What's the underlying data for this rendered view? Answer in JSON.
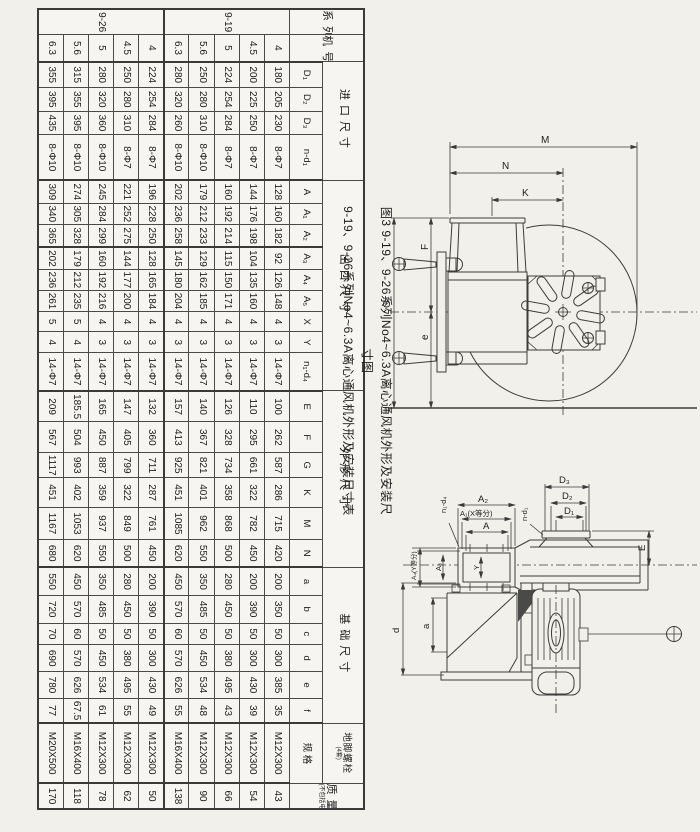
{
  "caption": {
    "line1": "图3  9-19、9-26系列No4~6.3A离心通风机外形及安装尺寸图",
    "line2": "9-19、9-26系列No4~6.3A离心通风机外形及安装尺寸表"
  },
  "table": {
    "header": {
      "series": "系列",
      "machine_no": "机号No",
      "groups": [
        {
          "label": "进口尺寸",
          "cols": [
            "D₁",
            "D₂",
            "D₃",
            "n-d₁"
          ]
        },
        {
          "label": "出口尺寸",
          "cols": [
            "A",
            "A₁",
            "A₂",
            "A₃",
            "A₄",
            "A₅",
            "X",
            "Y",
            "n₁-d₄"
          ]
        },
        {
          "label": "外形尺寸",
          "cols": [
            "E",
            "F",
            "G",
            "K",
            "M",
            "N"
          ]
        },
        {
          "label": "基础尺寸",
          "cols": [
            "a",
            "b",
            "c",
            "d",
            "e",
            "f"
          ]
        },
        {
          "label": "地脚螺栓",
          "sublabel": "(4套)",
          "cols": [
            "规 格"
          ]
        }
      ],
      "mass_label": "质量kg",
      "mass_sublabel": "(不包括电机)"
    },
    "rows": [
      {
        "series": "9-19",
        "no": "4",
        "v": [
          "180",
          "205",
          "230",
          "8-Φ7",
          "128",
          "160",
          "182",
          "92",
          "126",
          "148",
          "4",
          "3",
          "14-Φ7",
          "100",
          "262",
          "587",
          "286",
          "715",
          "420",
          "200",
          "350",
          "50",
          "300",
          "385",
          "35",
          "M12X300",
          "43"
        ]
      },
      {
        "series": "",
        "no": "4.5",
        "v": [
          "200",
          "225",
          "250",
          "8-Φ7",
          "144",
          "176",
          "198",
          "104",
          "135",
          "160",
          "4",
          "3",
          "14-Φ7",
          "110",
          "295",
          "661",
          "322",
          "782",
          "450",
          "200",
          "390",
          "50",
          "300",
          "430",
          "39",
          "M12X300",
          "54"
        ]
      },
      {
        "series": "",
        "no": "5",
        "v": [
          "224",
          "254",
          "284",
          "8-Φ7",
          "160",
          "192",
          "214",
          "115",
          "150",
          "171",
          "4",
          "3",
          "14-Φ7",
          "126",
          "328",
          "734",
          "358",
          "868",
          "500",
          "280",
          "450",
          "50",
          "380",
          "495",
          "43",
          "M12X300",
          "66"
        ]
      },
      {
        "series": "",
        "no": "5.6",
        "v": [
          "250",
          "280",
          "310",
          "8-Φ10",
          "179",
          "212",
          "233",
          "129",
          "162",
          "185",
          "4",
          "3",
          "14-Φ7",
          "140",
          "367",
          "821",
          "401",
          "962",
          "550",
          "350",
          "485",
          "50",
          "450",
          "534",
          "48",
          "M12X300",
          "90"
        ]
      },
      {
        "series": "",
        "no": "6.3",
        "v": [
          "280",
          "320",
          "260",
          "8-Φ10",
          "202",
          "236",
          "258",
          "145",
          "180",
          "204",
          "4",
          "3",
          "14-Φ7",
          "157",
          "413",
          "925",
          "451",
          "1085",
          "620",
          "450",
          "570",
          "60",
          "570",
          "626",
          "55",
          "M16X400",
          "138"
        ]
      },
      {
        "series": "9-26",
        "no": "4",
        "v": [
          "224",
          "254",
          "284",
          "8-Φ7",
          "196",
          "228",
          "250",
          "128",
          "165",
          "184",
          "4",
          "3",
          "14-Φ7",
          "132",
          "360",
          "711",
          "287",
          "761",
          "450",
          "200",
          "390",
          "50",
          "300",
          "430",
          "49",
          "M12X300",
          "50"
        ]
      },
      {
        "series": "",
        "no": "4.5",
        "v": [
          "250",
          "280",
          "310",
          "8-Φ7",
          "221",
          "252",
          "275",
          "144",
          "177",
          "200",
          "4",
          "3",
          "14-Φ7",
          "147",
          "405",
          "799",
          "322",
          "849",
          "500",
          "280",
          "450",
          "50",
          "380",
          "495",
          "55",
          "M12X300",
          "62"
        ]
      },
      {
        "series": "",
        "no": "5",
        "v": [
          "280",
          "320",
          "360",
          "8-Φ10",
          "245",
          "284",
          "299",
          "160",
          "192",
          "216",
          "4",
          "3",
          "14-Φ7",
          "165",
          "450",
          "887",
          "359",
          "937",
          "550",
          "350",
          "485",
          "50",
          "450",
          "534",
          "61",
          "M12X300",
          "78"
        ]
      },
      {
        "series": "",
        "no": "5.6",
        "v": [
          "315",
          "355",
          "395",
          "8-Φ10",
          "274",
          "305",
          "328",
          "179",
          "212",
          "235",
          "5",
          "4",
          "14-Φ7",
          "185.5",
          "504",
          "993",
          "402",
          "1053",
          "620",
          "450",
          "570",
          "60",
          "570",
          "626",
          "67.5",
          "M16X400",
          "118"
        ]
      },
      {
        "series": "",
        "no": "6.3",
        "v": [
          "355",
          "395",
          "435",
          "8-Φ10",
          "309",
          "340",
          "365",
          "202",
          "236",
          "261",
          "5",
          "4",
          "14-Φ7",
          "209",
          "567",
          "1117",
          "451",
          "1167",
          "680",
          "550",
          "720",
          "70",
          "690",
          "780",
          "77",
          "M20X500",
          "170"
        ]
      }
    ]
  },
  "drawings": {
    "side_view": {
      "M": "M",
      "N": "N",
      "K": "K",
      "G": "G",
      "F": "F",
      "e": "e"
    },
    "front_view": {
      "A2": "A₂",
      "A1x": "A₁(X等分)",
      "A": "A",
      "A3": "A₃",
      "A4y": "A₄(Y等分)",
      "Y": "Y",
      "nd4": "n₁-d₄",
      "nd1": "n-d₁",
      "D3": "D₃",
      "D2": "D₂",
      "D1": "D₁",
      "E": "E",
      "d": "d",
      "a": "a"
    }
  }
}
